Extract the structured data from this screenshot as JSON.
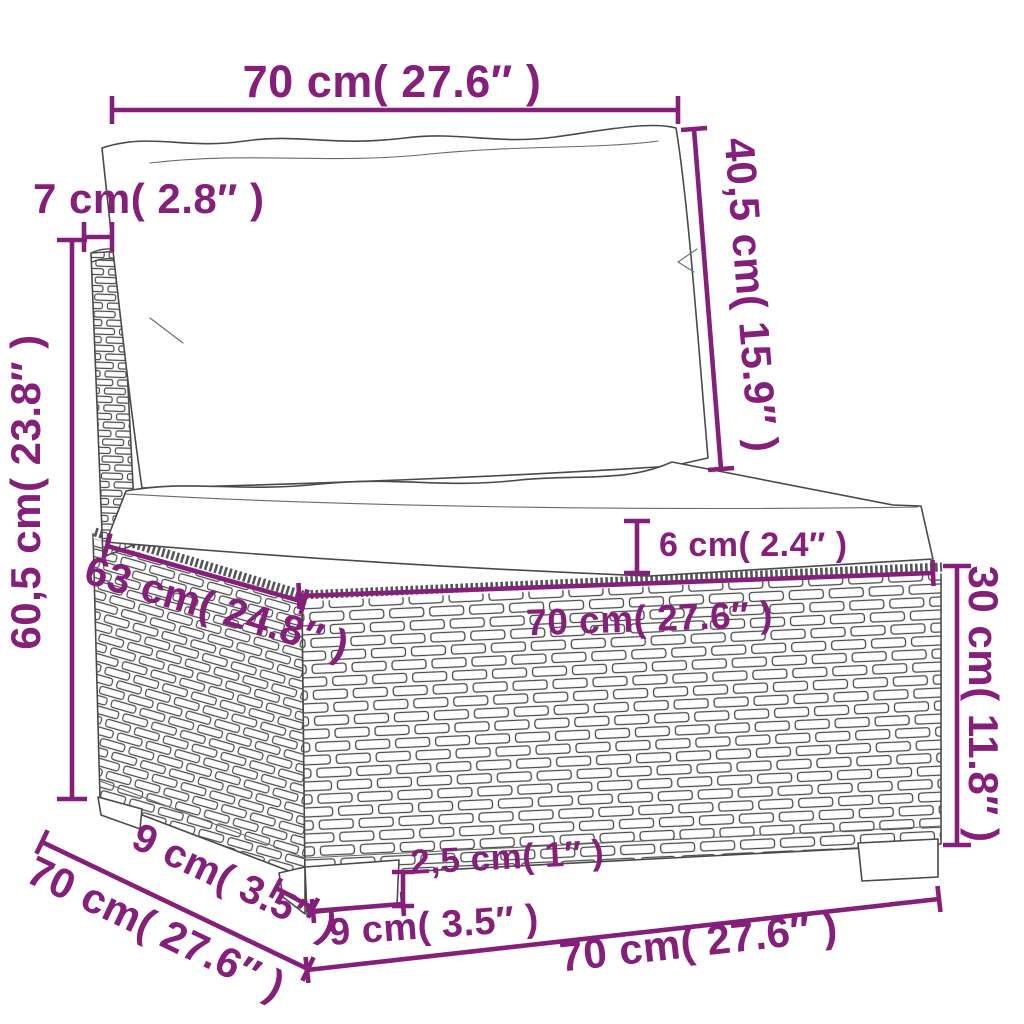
{
  "diagram": {
    "type": "furniture-dimension-diagram",
    "subject": "poly rattan garden sofa middle section with cushions",
    "accent_color": "#851F7A",
    "outline_color": "#4a4a4a",
    "background_color": "#ffffff",
    "dimensions": {
      "back_cushion_width": {
        "label": "70 cm( 27.6″ )",
        "value_cm": "70",
        "value_in": "27.6"
      },
      "back_cushion_height": {
        "label": "40,5 cm( 15.9″ )",
        "value_cm": "40,5",
        "value_in": "15.9"
      },
      "back_frame_thickness": {
        "label": "7 cm( 2.8″ )",
        "value_cm": "7",
        "value_in": "2.8"
      },
      "total_height": {
        "label": "60,5 cm( 23.8″ )",
        "value_cm": "60,5",
        "value_in": "23.8"
      },
      "seat_cushion_thickness": {
        "label": "6 cm( 2.4″ )",
        "value_cm": "6",
        "value_in": "2.4"
      },
      "seat_width": {
        "label": "70 cm( 27.6″ )",
        "value_cm": "70",
        "value_in": "27.6"
      },
      "seat_depth": {
        "label": "63 cm( 24.8″ )",
        "value_cm": "63",
        "value_in": "24.8"
      },
      "base_height": {
        "label": "30 cm( 11.8″ )",
        "value_cm": "30",
        "value_in": "11.8"
      },
      "overall_depth": {
        "label": "70 cm( 27.6″ )",
        "value_cm": "70",
        "value_in": "27.6"
      },
      "leg_depth": {
        "label": "9 cm( 3.5″ )",
        "value_cm": "9",
        "value_in": "3.5"
      },
      "foot_height": {
        "label": "2,5 cm( 1″ )",
        "value_cm": "2,5",
        "value_in": "1"
      },
      "leg_width": {
        "label": "9 cm( 3.5″ )",
        "value_cm": "9",
        "value_in": "3.5"
      },
      "overall_width": {
        "label": "70 cm( 27.6″ )",
        "value_cm": "70",
        "value_in": "27.6"
      }
    }
  }
}
